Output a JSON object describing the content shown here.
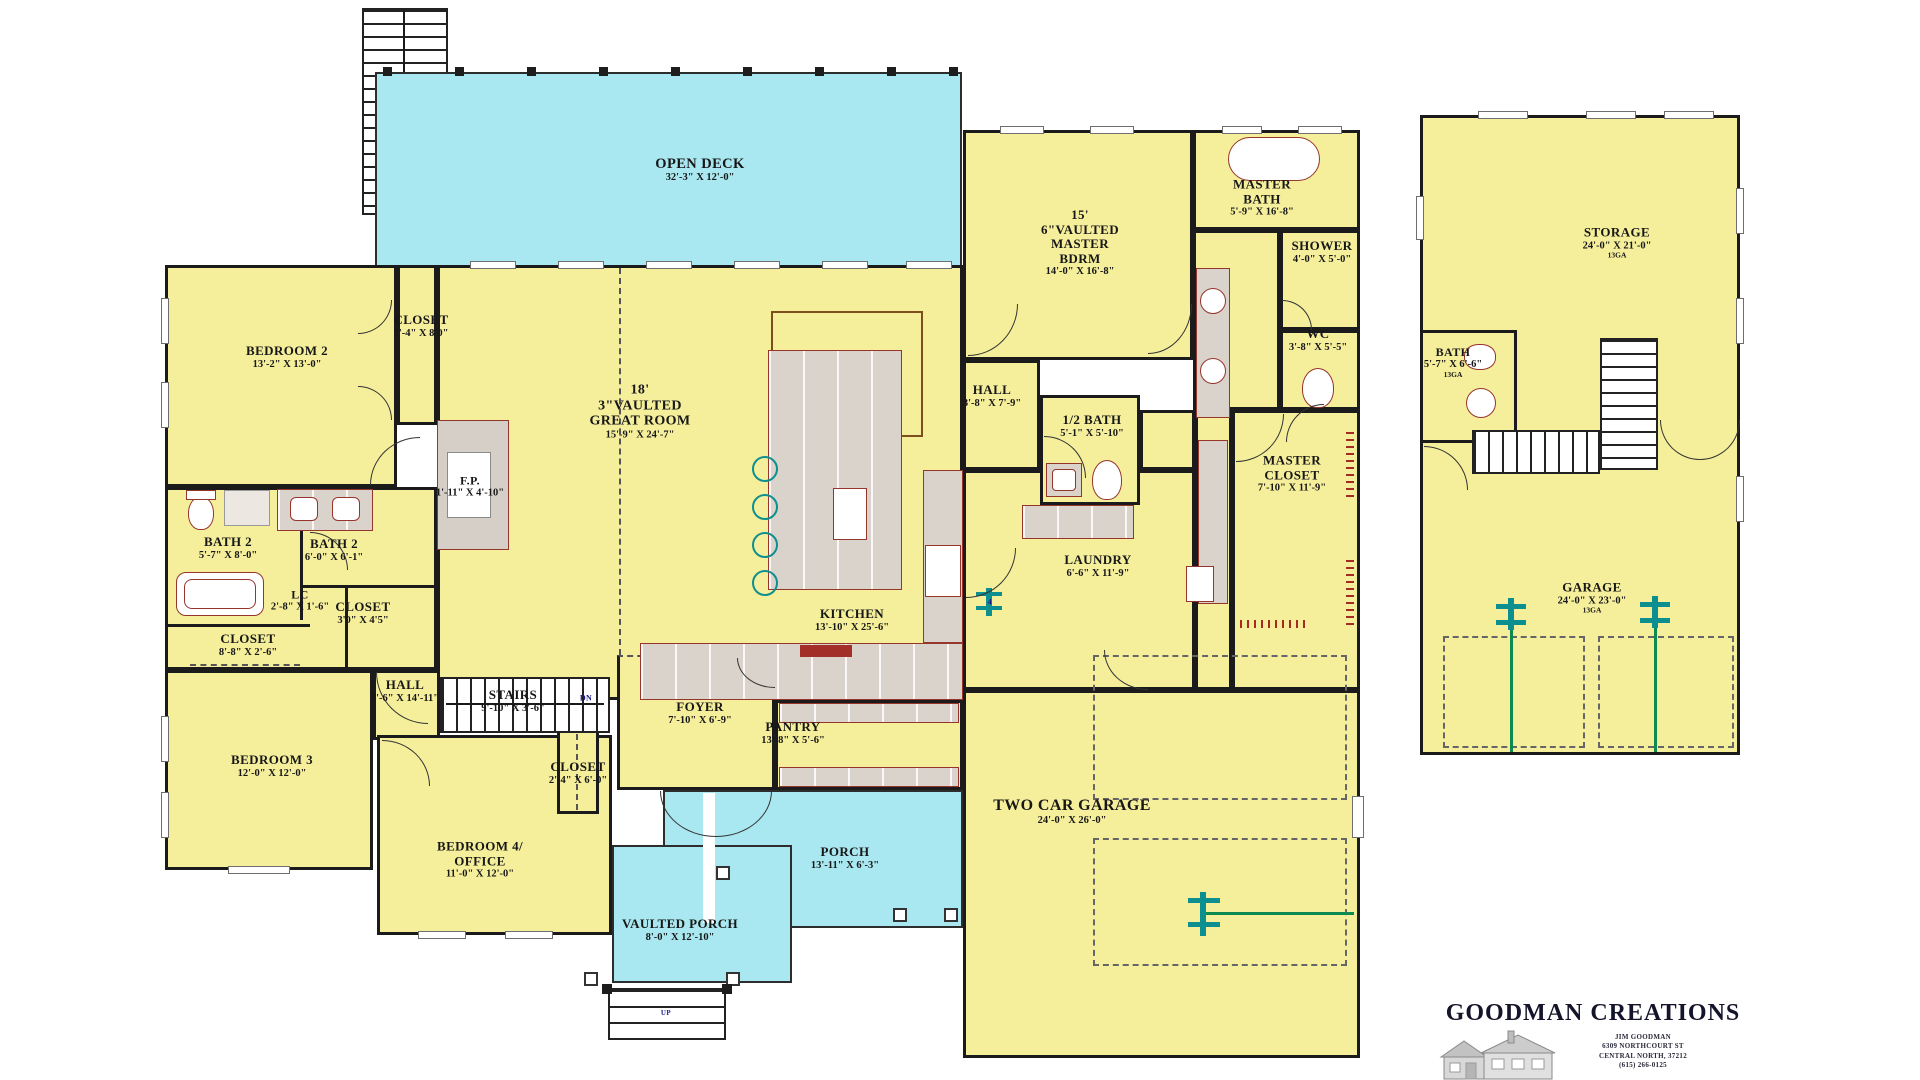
{
  "title": "House floor plan",
  "colors": {
    "room_fill": "#F5EF9C",
    "porch_fill": "#A9E8F0",
    "wall": "#1b1b1b",
    "fixture_outline": "#96352c",
    "stool_teal": "#0e8f8f",
    "ceiling_line_brown": "#7a4f1c",
    "note_blue": "#1a1a8c",
    "garage_line_green": "#0c8a50"
  },
  "labels": [
    {
      "n": "open-deck",
      "l": [
        "OPEN DECK",
        "32'-3\" X 12'-0\""
      ],
      "x": 700,
      "y": 170,
      "fs": 14.5
    },
    {
      "n": "bedroom-2",
      "l": [
        "BEDROOM 2",
        "13'-2\" X 13'-0\""
      ],
      "x": 287,
      "y": 357
    },
    {
      "n": "closet-bedroom-2",
      "l": [
        "CLOSET",
        "2'-4\" X 8'0\""
      ],
      "x": 421,
      "y": 326
    },
    {
      "n": "great-room",
      "l": [
        "18'",
        "3\"VAULTED",
        "GREAT ROOM",
        "15'-9\" X 24'-7\""
      ],
      "x": 640,
      "y": 412,
      "fs": 14
    },
    {
      "n": "fireplace",
      "l": [
        "F.P.",
        "1'-11\" X 4'-10\""
      ],
      "x": 470,
      "y": 487,
      "fs": 12
    },
    {
      "n": "bath-2-left",
      "l": [
        "BATH 2",
        "5'-7\" X 8'-0\""
      ],
      "x": 228,
      "y": 548
    },
    {
      "n": "bath-2-right",
      "l": [
        "BATH 2",
        "6'-0\" X 6'-1\""
      ],
      "x": 334,
      "y": 550
    },
    {
      "n": "linen-closet",
      "l": [
        "LC",
        "2'-8\" X 1'-6\""
      ],
      "x": 300,
      "y": 601,
      "fs": 12
    },
    {
      "n": "closet-hall",
      "l": [
        "CLOSET",
        "3'0\" X 4'5\""
      ],
      "x": 363,
      "y": 613
    },
    {
      "n": "closet-bedroom-3",
      "l": [
        "CLOSET",
        "8'-8\" X 2'-6\""
      ],
      "x": 248,
      "y": 645
    },
    {
      "n": "hall-left",
      "l": [
        "HALL",
        "3'-6\" X 14'-11\""
      ],
      "x": 405,
      "y": 691
    },
    {
      "n": "stairs-main",
      "l": [
        "STAIRS",
        "9'-10\" X 3'-6\""
      ],
      "x": 513,
      "y": 701
    },
    {
      "n": "stairs-dn",
      "l": [
        "DN"
      ],
      "x": 586,
      "y": 699,
      "fs": 8,
      "color": "#1a1a8c"
    },
    {
      "n": "bedroom-3",
      "l": [
        "BEDROOM 3",
        "12'-0\" X 12'-0\""
      ],
      "x": 272,
      "y": 766
    },
    {
      "n": "closet-bedroom-4",
      "l": [
        "CLOSET",
        "2'-4\" X 6'-0\""
      ],
      "x": 578,
      "y": 773
    },
    {
      "n": "bedroom-4-office",
      "l": [
        "BEDROOM 4/",
        "OFFICE",
        "11'-0\" X 12'-0\""
      ],
      "x": 480,
      "y": 860
    },
    {
      "n": "vaulted-porch",
      "l": [
        "VAULTED PORCH",
        "8'-0\" X 12'-10\""
      ],
      "x": 680,
      "y": 930
    },
    {
      "n": "foyer",
      "l": [
        "FOYER",
        "7'-10\" X 6'-9\""
      ],
      "x": 700,
      "y": 713
    },
    {
      "n": "pantry",
      "l": [
        "PANTRY",
        "13'-8\" X 5'-6\""
      ],
      "x": 793,
      "y": 733
    },
    {
      "n": "kitchen",
      "l": [
        "KITCHEN",
        "13'-10\" X 25'-6\""
      ],
      "x": 852,
      "y": 620
    },
    {
      "n": "porch",
      "l": [
        "PORCH",
        "13'-11\" X 6'-3\""
      ],
      "x": 845,
      "y": 858
    },
    {
      "n": "two-car-garage",
      "l": [
        "TWO CAR GARAGE",
        "24'-0\" X 26'-0\""
      ],
      "x": 1072,
      "y": 812,
      "fs": 16
    },
    {
      "n": "master-bedroom",
      "l": [
        "15'",
        "6\"VAULTED",
        "MASTER",
        "BDRM",
        "14'-0\" X 16'-8\""
      ],
      "x": 1080,
      "y": 243
    },
    {
      "n": "master-bath",
      "l": [
        "MASTER",
        "BATH",
        "5'-9\" X 16'-8\""
      ],
      "x": 1262,
      "y": 198
    },
    {
      "n": "shower",
      "l": [
        "SHOWER",
        "4'-0\" X 5'-0\""
      ],
      "x": 1322,
      "y": 252
    },
    {
      "n": "wc",
      "l": [
        "WC",
        "3'-8\" X 5'-5\""
      ],
      "x": 1318,
      "y": 340
    },
    {
      "n": "hall-master",
      "l": [
        "HALL",
        "3'-8\" X 7'-9\""
      ],
      "x": 992,
      "y": 396
    },
    {
      "n": "half-bath",
      "l": [
        "1/2 BATH",
        "5'-1\" X 5'-10\""
      ],
      "x": 1092,
      "y": 426
    },
    {
      "n": "master-closet",
      "l": [
        "MASTER",
        "CLOSET",
        "7'-10\" X 11'-9\""
      ],
      "x": 1292,
      "y": 474
    },
    {
      "n": "laundry",
      "l": [
        "LAUNDRY",
        "6'-6\" X 11'-9\""
      ],
      "x": 1098,
      "y": 566
    },
    {
      "n": "storage",
      "l": [
        "STORAGE",
        "24'-0\" X 21'-0\"",
        "13GA"
      ],
      "x": 1617,
      "y": 243
    },
    {
      "n": "bath-detached",
      "l": [
        "BATH",
        "5'-7\" X 6'-6\"",
        "13GA"
      ],
      "x": 1453,
      "y": 363,
      "fs": 12
    },
    {
      "n": "garage-detached",
      "l": [
        "GARAGE",
        "24'-0\" X 23'-0\"",
        "13GA"
      ],
      "x": 1592,
      "y": 598
    },
    {
      "n": "steps-up",
      "l": [
        "UP"
      ],
      "x": 666,
      "y": 1014,
      "fs": 7,
      "color": "#1a1a8c"
    },
    {
      "n": "garage-note-4",
      "l": [
        "4"
      ],
      "x": 990,
      "y": 603,
      "fs": 8,
      "color": "#1a1a8c"
    }
  ],
  "logo": {
    "title": "GOODMAN CREATIONS",
    "lines": [
      "JIM GOODMAN",
      "6309 NORTHCOURT ST",
      "CENTRAL NORTH, 37212",
      "(615) 266-0125"
    ]
  }
}
